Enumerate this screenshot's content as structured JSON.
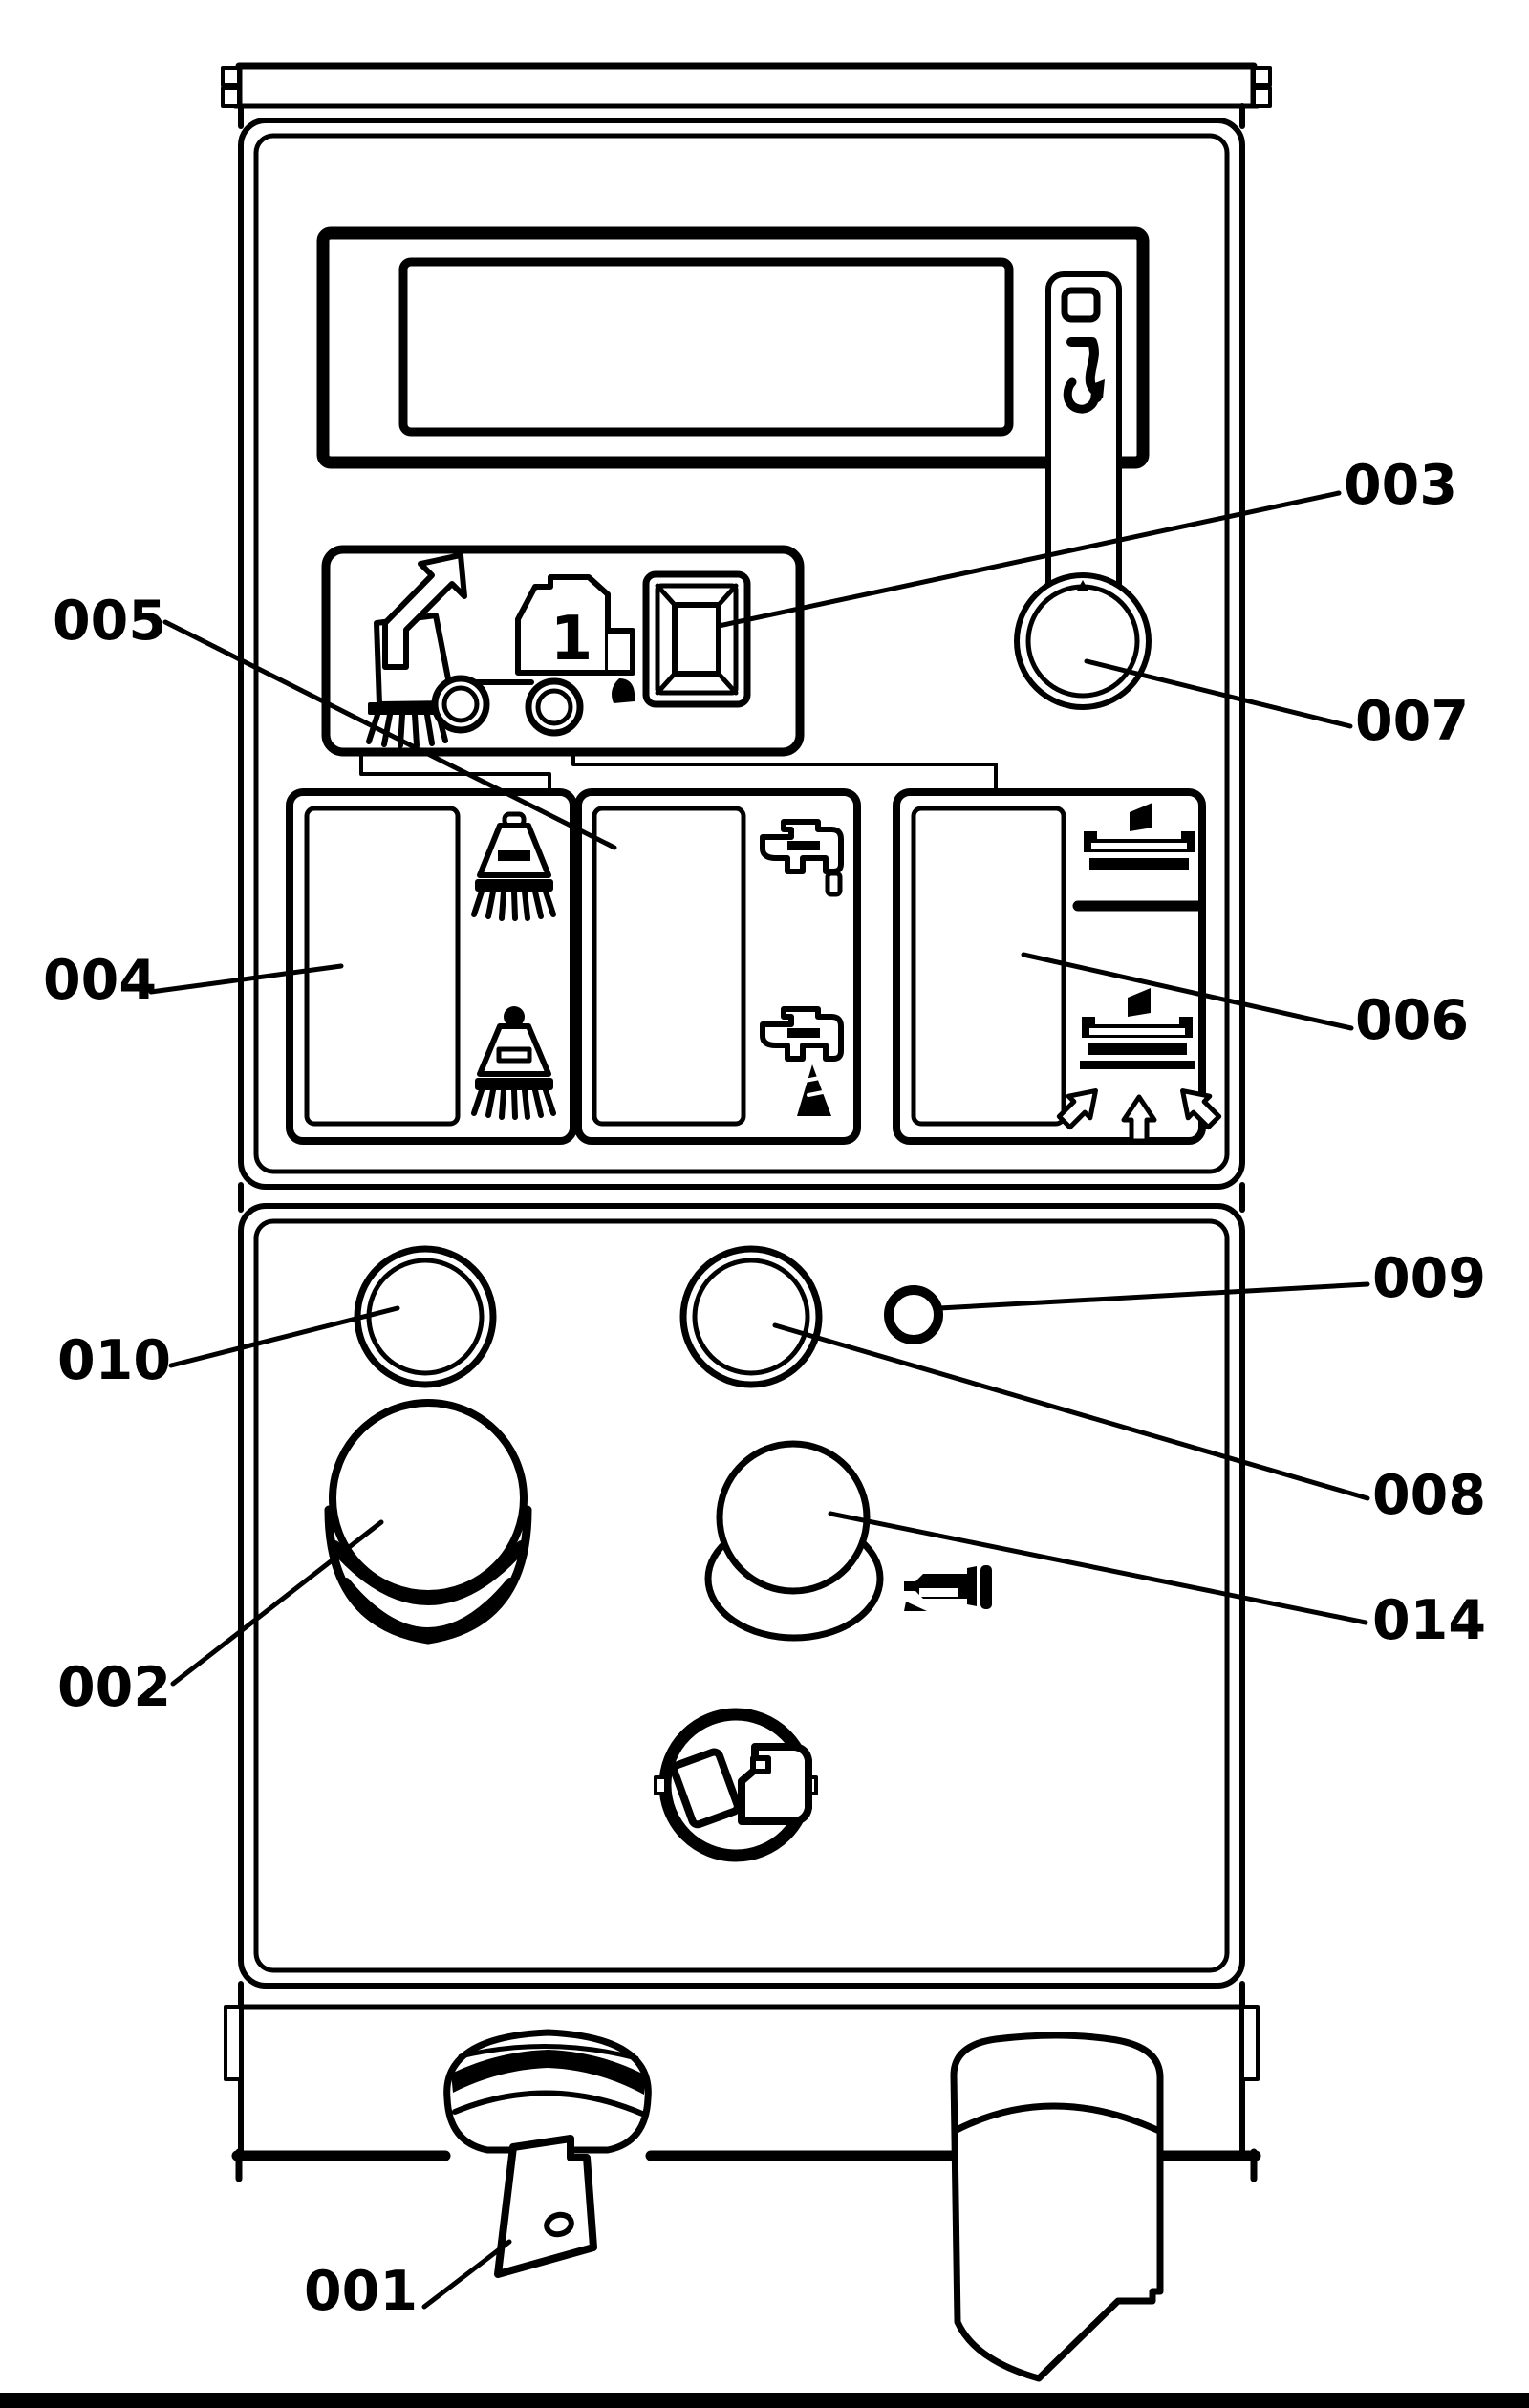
{
  "diagram": {
    "type": "technical-line-diagram",
    "subject": "sweeper machine operator control panel with numbered part callouts",
    "background_color": "#ffffff",
    "line_color": "#000000"
  },
  "truck": {
    "number_label": "1"
  },
  "callouts": {
    "c001": {
      "label": "001",
      "target": "ignition-key-switch"
    },
    "c002": {
      "label": "002",
      "target": "emergency-stop-button"
    },
    "c003": {
      "label": "003",
      "target": "square-select-button"
    },
    "c004": {
      "label": "004",
      "target": "brush-switch-block"
    },
    "c005": {
      "label": "005",
      "target": "water-switch-block"
    },
    "c006": {
      "label": "006",
      "target": "squeegee-switch-block"
    },
    "c007": {
      "label": "007",
      "target": "rotary-knob"
    },
    "c008": {
      "label": "008",
      "target": "round-button"
    },
    "c009": {
      "label": "009",
      "target": "small-round-button"
    },
    "c010": {
      "label": "010",
      "target": "round-button"
    },
    "c014": {
      "label": "014",
      "target": "horn-button"
    }
  },
  "icons": [
    "info-icon",
    "sweeper-truck-icon",
    "brush-raise-icon",
    "brush-lower-icon",
    "water-tap-icon",
    "water-tap-spray-icon",
    "squeegee-icon",
    "squeegee-suction-icon",
    "horn-icon",
    "seatbelt-icon",
    "key-icon"
  ]
}
